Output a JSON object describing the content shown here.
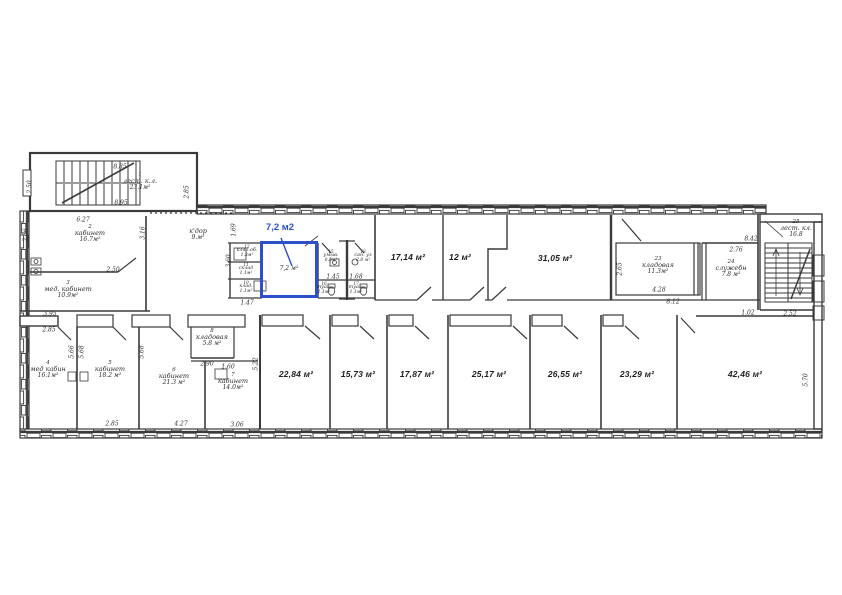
{
  "highlight": {
    "callout": "7,2 м2",
    "area": "7,2 м²",
    "color": "#2b50c8"
  },
  "drawing": {
    "line_color": "#3a3a3a",
    "paper_color": "#ffffff"
  },
  "rooms": [
    {
      "num": "1",
      "name": "лест. к.л.",
      "area": "23.1м²"
    },
    {
      "num": "2",
      "name": "кабинет",
      "area": "16.7м²"
    },
    {
      "num": "3",
      "name": "мед. кабинет",
      "area": "10.9м²"
    },
    {
      "num": "4",
      "name": "мед кабин",
      "area": "16.1м²"
    },
    {
      "num": "5",
      "name": "кабинет",
      "area": "18.2 м²"
    },
    {
      "num": "6",
      "name": "кабинет",
      "area": "21.3 м²"
    },
    {
      "num": "7",
      "name": "кабинет",
      "area": "14.0м²"
    },
    {
      "num": "8",
      "name": "кладовая",
      "area": "5.8 м²"
    },
    {
      "num": "",
      "name": "к'дор",
      "area": "9.м²"
    },
    {
      "num": "10",
      "name": "клад.",
      "area": "1.1м²"
    },
    {
      "num": "11",
      "name": "склад",
      "area": "1.1м²"
    },
    {
      "num": "12",
      "name": "клад.об.",
      "area": "1.3м²"
    },
    {
      "num": "15",
      "name": "умыв.",
      "area": "0.5м²"
    },
    {
      "num": "16",
      "name": "туал.",
      "area": "1.1м²"
    },
    {
      "num": "17",
      "name": "туал.",
      "area": "1.1м²"
    },
    {
      "num": "18",
      "name": "сан. уз",
      "area": "2.8 м²"
    },
    {
      "num": "23",
      "name": "кладовая",
      "area": "11.3м²"
    },
    {
      "num": "24",
      "name": "служебн",
      "area": "7.8 м²"
    },
    {
      "num": "25",
      "name": "лест. кл.",
      "area": "16.8"
    }
  ],
  "halls": [
    "17,14 м²",
    "12 м²",
    "31,05 м²"
  ],
  "offices": [
    "22,84 м²",
    "15,73 м²",
    "17,87 м²",
    "25,17 м²",
    "26,55 м²",
    "23,29 м²",
    "42,46 м²"
  ],
  "dims": [
    "8.85",
    "2.50",
    "8.95",
    "2.85",
    "6.27",
    "2.66",
    "3.16",
    "2.50",
    "3.95",
    "2.85",
    "5.66",
    "5.68",
    "5.68",
    "2.85",
    "4.27",
    "3.06",
    "2.90",
    "1.60",
    "5.22",
    "1.69",
    "3.60",
    "1.47",
    "1.45",
    "1.68",
    "4.28",
    "8.12",
    "2.65",
    "2.76",
    "8.42",
    "1.02",
    "2.52",
    "5.70"
  ]
}
